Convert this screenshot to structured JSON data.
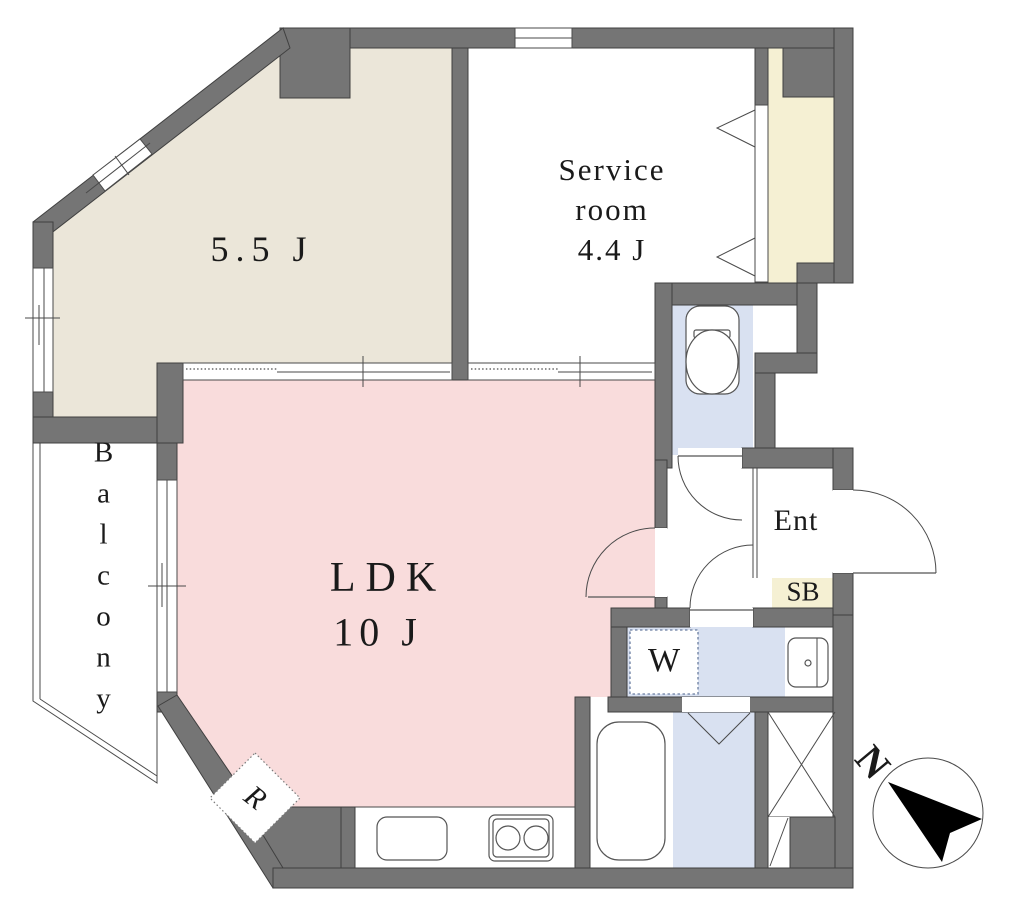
{
  "plan": {
    "rooms": {
      "bedroom": {
        "size_label": "5.5 J"
      },
      "service_room": {
        "name_line1": "Service",
        "name_line2": "room",
        "size_label": "4.4 J"
      },
      "ldk": {
        "name": "LDK",
        "size_label": "10 J"
      },
      "balcony": {
        "name": "Balcony"
      },
      "entrance": {
        "abbr": "Ent"
      },
      "shoe_box": {
        "abbr": "SB"
      },
      "washer_space": {
        "abbr": "W"
      },
      "refrigerator_space": {
        "abbr": "R"
      }
    },
    "compass": {
      "north": "N"
    },
    "colors": {
      "wall": "#757575",
      "bedroom": "#EBE6D9",
      "ldk": "#F9DCDC",
      "wet": "#D9E1F1",
      "closet": "#F5F0D3",
      "outline": "#404040"
    }
  }
}
